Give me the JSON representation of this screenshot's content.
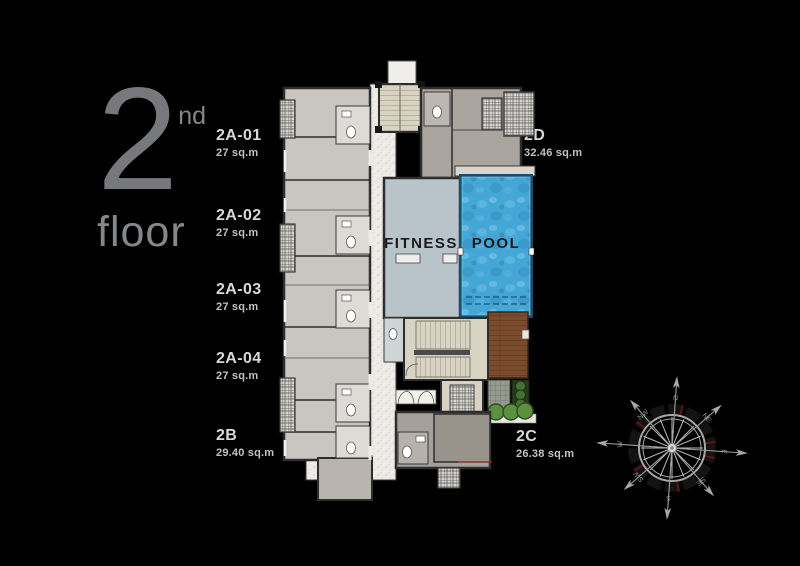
{
  "page": {
    "background": "#000000"
  },
  "floor_indicator": {
    "number": "2",
    "ordinal": "nd",
    "label": "floor"
  },
  "unit_labels": {
    "left": [
      {
        "id": "2A-01",
        "area": "27 sq.m"
      },
      {
        "id": "2A-02",
        "area": "27 sq.m"
      },
      {
        "id": "2A-03",
        "area": "27 sq.m"
      },
      {
        "id": "2A-04",
        "area": "27 sq.m"
      },
      {
        "id": "2B",
        "area": "29.40 sq.m"
      }
    ],
    "right_top": {
      "id": "2D",
      "area": "32.46 sq.m"
    },
    "right_bottom": {
      "id": "2C",
      "area": "26.38 sq.m"
    }
  },
  "plan": {
    "fitness_label": "FITNESS",
    "pool_label": "POOL"
  },
  "compass": {
    "directions": [
      "N",
      "NE",
      "E",
      "SE",
      "S",
      "SW",
      "W",
      "NW"
    ]
  },
  "colors": {
    "background": "#000000",
    "floor_text": "#76787b",
    "label_text": "#d8d8d8",
    "unit_fill": "#c9c6c1",
    "unit_dark": "#a9a49d",
    "wall": "#2d2d2d",
    "corridor": "#edebe6",
    "fitness": "#b9c4ca",
    "pool_water": "#45a7d6",
    "pool_rim": "#17506e",
    "deck_wood": "#7a4b2c",
    "stair": "#d9d3c4",
    "plants": "#5c8f3f"
  }
}
